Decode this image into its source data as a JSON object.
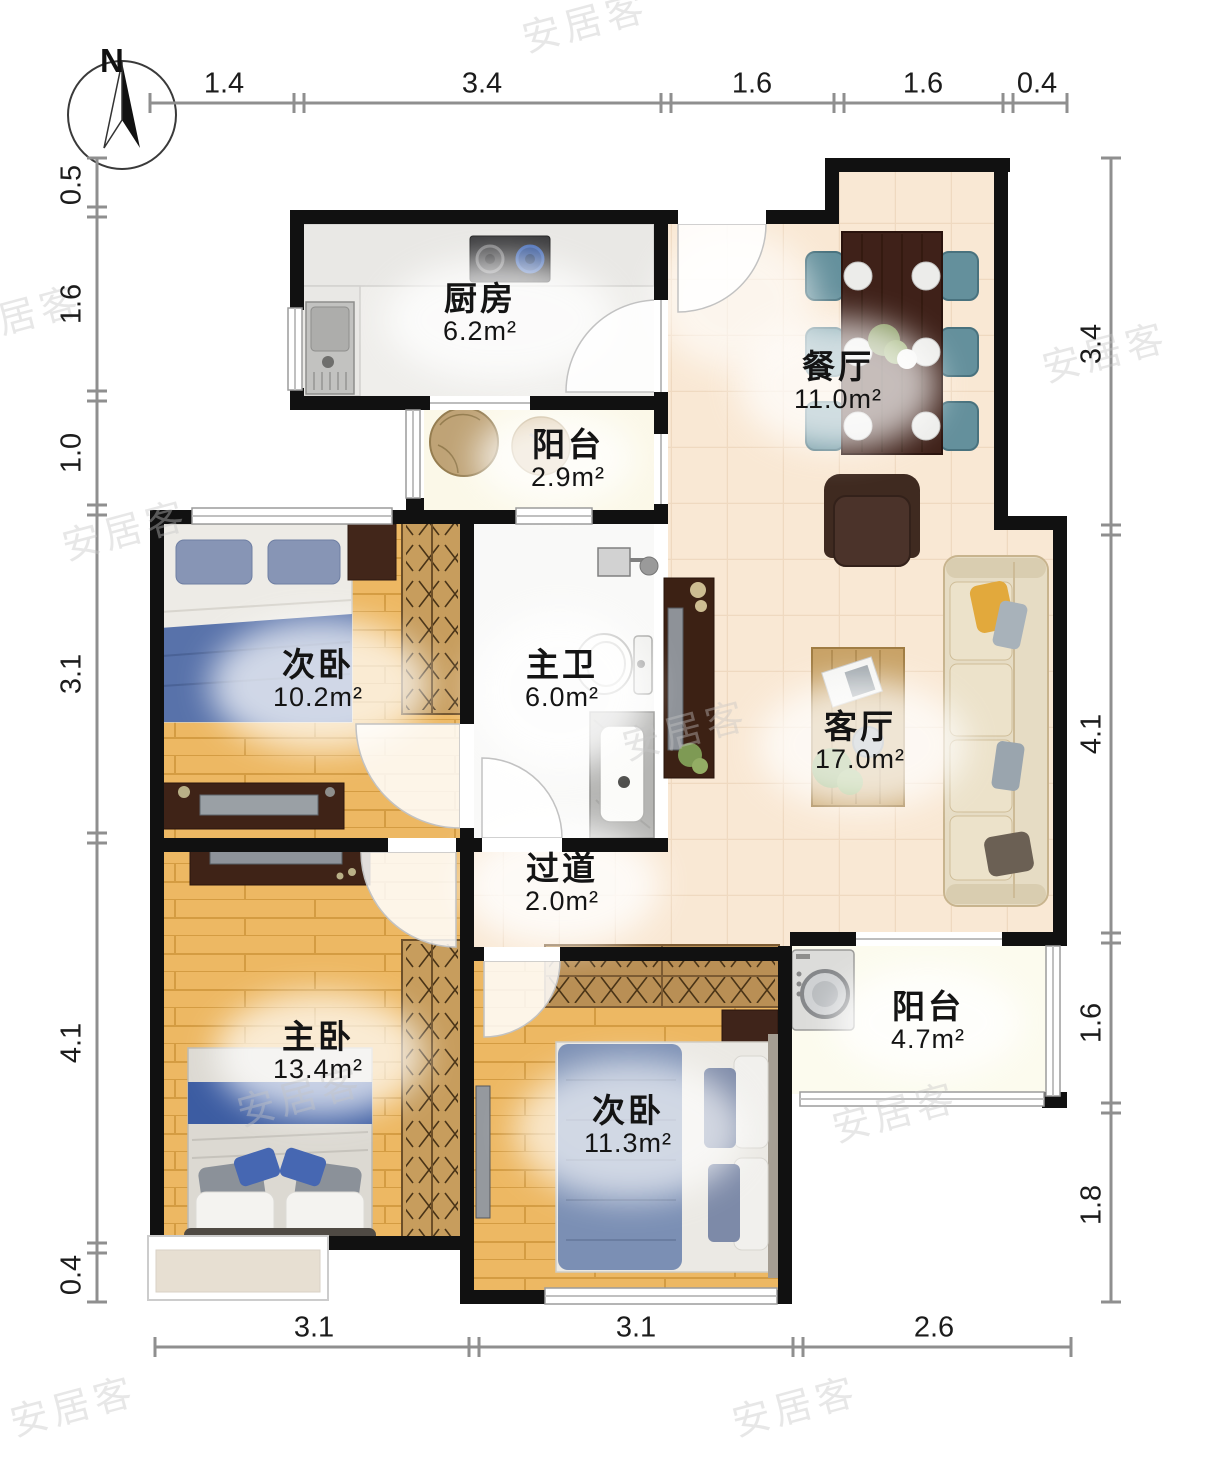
{
  "compass": {
    "label": "N"
  },
  "watermark": {
    "text": "安居客"
  },
  "rooms": [
    {
      "id": "kitchen",
      "name": "厨房",
      "area": "6.2m²"
    },
    {
      "id": "dining-room",
      "name": "餐厅",
      "area": "11.0m²"
    },
    {
      "id": "balcony-north",
      "name": "阳台",
      "area": "2.9m²"
    },
    {
      "id": "second-bedroom-n",
      "name": "次卧",
      "area": "10.2m²"
    },
    {
      "id": "master-bathroom",
      "name": "主卫",
      "area": "6.0m²"
    },
    {
      "id": "living-room",
      "name": "客厅",
      "area": "17.0m²"
    },
    {
      "id": "hallway",
      "name": "过道",
      "area": "2.0m²"
    },
    {
      "id": "master-bedroom",
      "name": "主卧",
      "area": "13.4m²"
    },
    {
      "id": "second-bedroom-s",
      "name": "次卧",
      "area": "11.3m²"
    },
    {
      "id": "balcony-south",
      "name": "阳台",
      "area": "4.7m²"
    }
  ],
  "dimensions": {
    "top": [
      "1.4",
      "3.4",
      "1.6",
      "1.6",
      "0.4"
    ],
    "left": [
      "0.5",
      "1.6",
      "1.0",
      "3.1",
      "4.1",
      "0.4"
    ],
    "right": [
      "3.4",
      "4.1",
      "1.6",
      "1.8"
    ],
    "bottom": [
      "3.1",
      "3.1",
      "2.6"
    ]
  },
  "colors": {
    "wall": "#111111",
    "tile_floor": "#f9e8d4",
    "wood_floor": "#edb863",
    "balcony_floor": "#fbf8e8",
    "ruler": "#8f8f8f",
    "watermark": "#c5c5c5"
  }
}
